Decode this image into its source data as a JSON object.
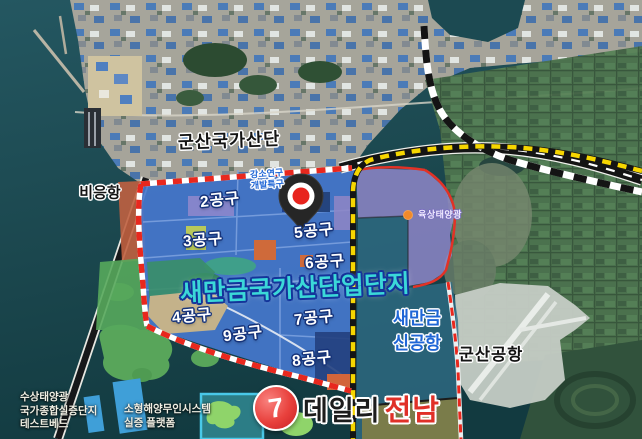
{
  "colors": {
    "sea": "#1e4c52",
    "complex-blue": "#4577cd",
    "purple-zone": "#968bd1",
    "airport-zone": "#2f6d87",
    "title-cyan": "#3bd8d8",
    "label-blue": "#1f66d6",
    "border-red": "#e8281e",
    "border-yellow": "#f6d600",
    "watermark-red": "#e03028"
  },
  "map": {
    "title": "새만금국가산단업단지",
    "region_labels": {
      "gunsan_national_complex": "군산국가산단",
      "bieung_port": "비응항",
      "gunsan_airport": "군산공항"
    },
    "research_zone": {
      "line1": "강소연구",
      "line2": "개발특구"
    },
    "onshore_solar_label": "육상태양광",
    "new_airport": {
      "line1": "새만금",
      "line2": "신공항"
    },
    "floating_solar": {
      "line1": "수상태양광",
      "line2": "국가종합실증단지",
      "line3": "테스트베드"
    },
    "marine_system": {
      "line1": "소형해양무인시스템",
      "line2": "실증 플랫폼"
    },
    "zones": [
      {
        "label": "2공구"
      },
      {
        "label": "3공구"
      },
      {
        "label": "5공구"
      },
      {
        "label": "6공구"
      },
      {
        "label": "4공구"
      },
      {
        "label": "9공구"
      },
      {
        "label": "7공구"
      },
      {
        "label": "8공구"
      }
    ]
  },
  "watermark": {
    "glyph": "7",
    "name_black": "데일리",
    "name_red": "전남"
  }
}
